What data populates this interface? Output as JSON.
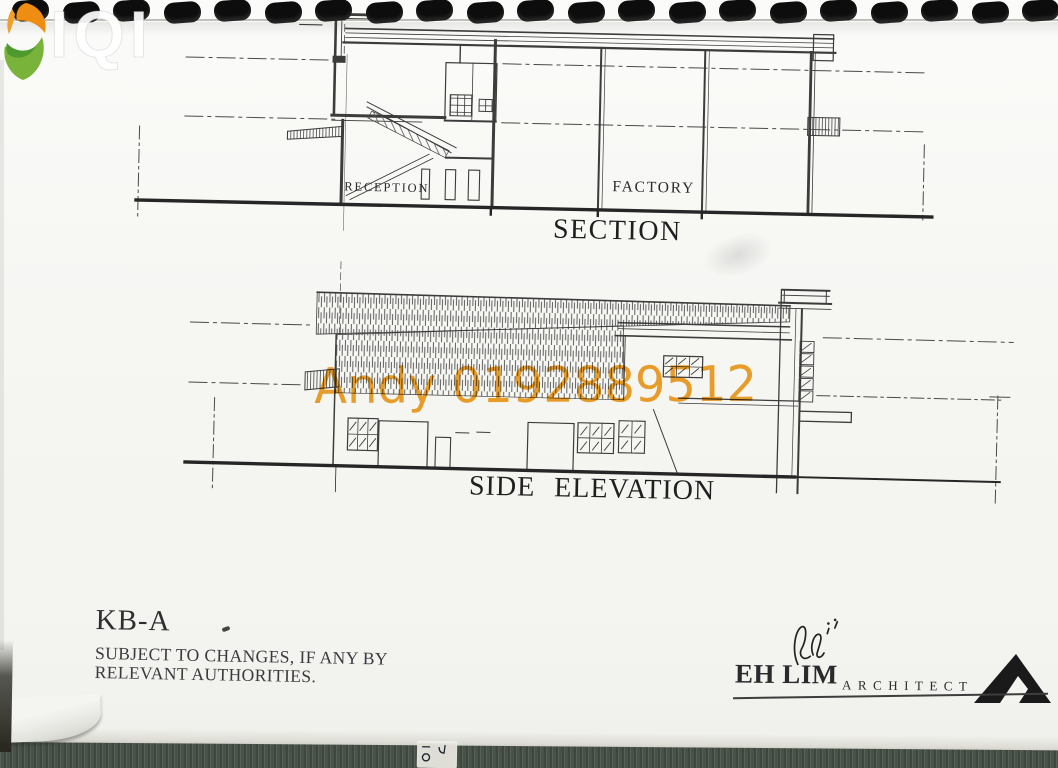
{
  "page": {
    "ghost_logo_text": "IQI",
    "watermark": {
      "text": "Andy 0192889512",
      "color": "#f09c1b"
    }
  },
  "section": {
    "title": "SECTION",
    "room_labels": {
      "reception": "RECEPTION",
      "factory": "FACTORY"
    }
  },
  "elevation": {
    "title": "SIDE ELEVATION"
  },
  "footer": {
    "drawing_code": "KB-A",
    "disclaimer_line1": "SUBJECT TO CHANGES, IF ANY BY",
    "disclaimer_line2": "RELEVANT AUTHORITIES.",
    "architect_name": "EH LIM",
    "architect_title": "ARCHITECT"
  }
}
